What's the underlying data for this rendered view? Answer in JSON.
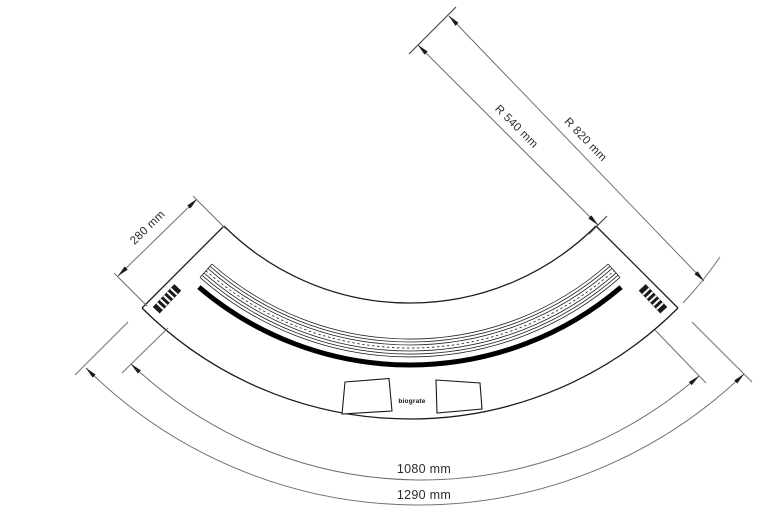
{
  "drawing": {
    "title": "curved-fireplace-top-view-dimension-drawing",
    "dimensions": {
      "radius_inner": "R 540 mm",
      "radius_outer": "R 820 mm",
      "depth": "280 mm",
      "arc_inner": "1080 mm",
      "arc_outer": "1290 mm"
    },
    "logo": "biograte",
    "colors": {
      "drawing_line": "#1a1a1a",
      "dimension_line": "#707070",
      "label_text": "#2b2b2b",
      "background": "#ffffff"
    }
  }
}
